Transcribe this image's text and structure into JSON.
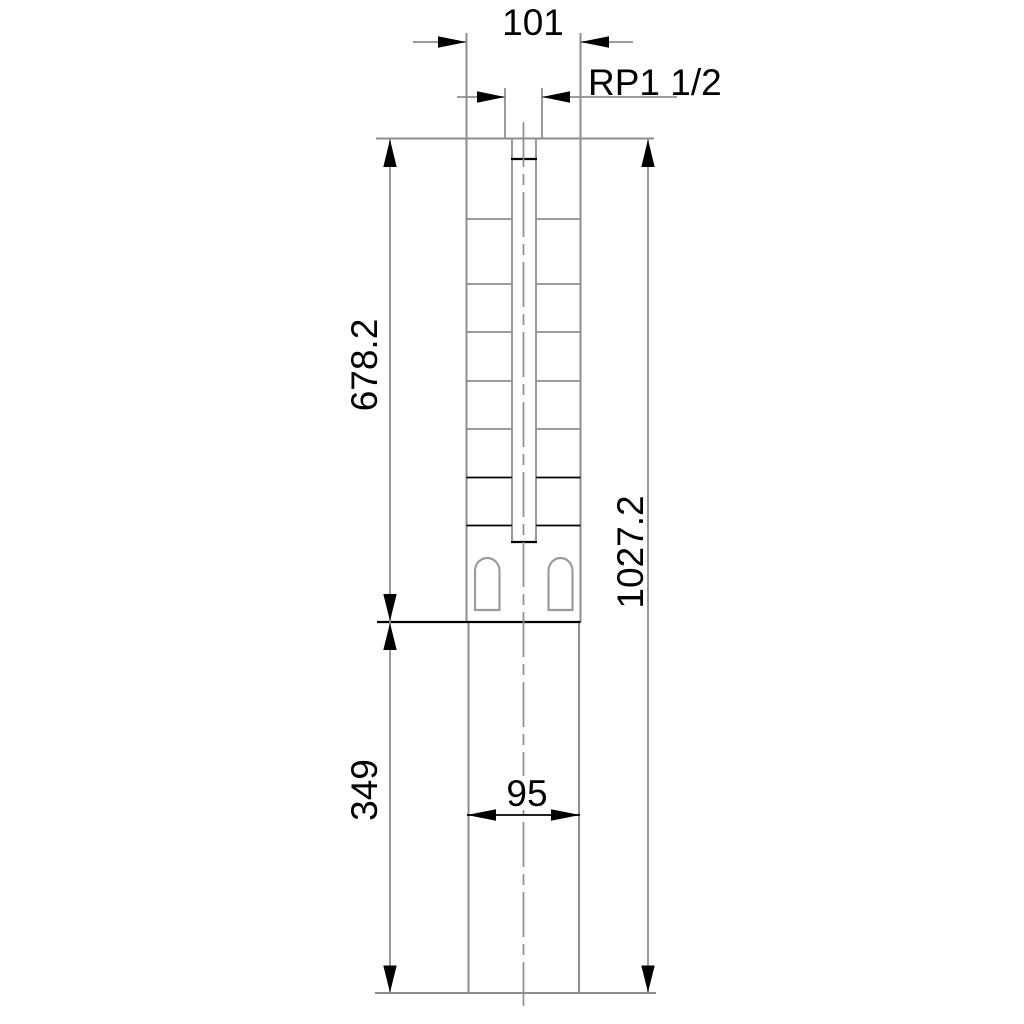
{
  "drawing": {
    "colors": {
      "background": "#ffffff",
      "line_gray": "#8e8e8e",
      "slot_gray": "#9c9c9c",
      "ink_black": "#000000"
    },
    "dimensions": {
      "outlet_width": {
        "label": "101"
      },
      "thread": {
        "label": "RP1 1/2"
      },
      "pump_section_length": {
        "label": "678.2"
      },
      "overall_length": {
        "label": "1027.2"
      },
      "motor_section_length": {
        "label": "349"
      },
      "motor_width": {
        "label": "95"
      }
    }
  }
}
